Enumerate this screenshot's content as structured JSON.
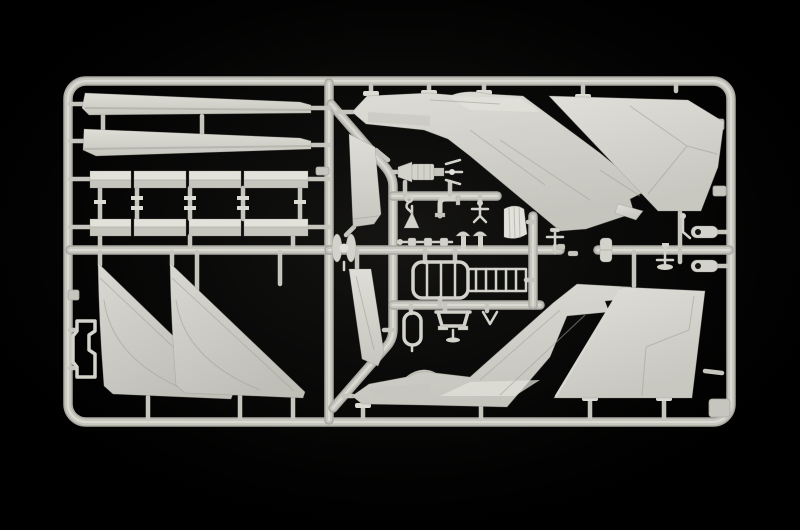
{
  "meta": {
    "title": "Model kit sprue photograph",
    "alt": "Photograph of a light grey injection-moulded plastic model aircraft sprue on a black background, containing delta wing panels, fuselage halves, tail fins, wing slats, elevon strips and many small detail parts attached to a rectangular runner frame"
  },
  "colors": {
    "bg": "#000000",
    "vignette": "#2c2b28",
    "plastic": "#d3d2cb",
    "plastic_hi": "#e2e1da",
    "plastic_mid": "#c6c5be",
    "plastic_lo": "#b2b1aa",
    "runner": "#c6c5be",
    "runner_hi": "#dbdad3",
    "runner_lo": "#a9a8a1",
    "panel": "#a3a29b",
    "hole": "#141412"
  },
  "sprue": {
    "material": "light grey styrene plastic",
    "background": "black studio backdrop",
    "frame": {
      "shape": "rounded rectangle runner frame with internal vertical divider, curved spine runner and horizontal cluster runners",
      "corner_gusset": "bottom-right inner corner pad"
    },
    "parts": [
      {
        "name": "wing-slat-upper",
        "desc": "long tapered leading-edge slat strip, top left"
      },
      {
        "name": "wing-slat-lower",
        "desc": "long tapered leading-edge slat strip, second row"
      },
      {
        "name": "elevon-row-upper",
        "desc": "row of four flat elevon/flap segments"
      },
      {
        "name": "elevon-row-lower",
        "desc": "row of four flat elevon/flap segments"
      },
      {
        "name": "elevon-links",
        "desc": "vertical moulding links with flanges joining the two elevon rows"
      },
      {
        "name": "delta-wing-left",
        "desc": "large triangular delta wing panel"
      },
      {
        "name": "delta-wing-right",
        "desc": "large triangular delta wing panel"
      },
      {
        "name": "canopy-frame-bracket",
        "desc": "small open rectangular frame part on left edge"
      },
      {
        "name": "rudder-panel-upper",
        "desc": "narrow trapezoid panel beside curved spine runner"
      },
      {
        "name": "rudder-panel-lower",
        "desc": "narrow slanted panel below centre"
      },
      {
        "name": "fuselage-half-upper",
        "desc": "fuselage half, nose left, tail swept down-right with stepped exhaust"
      },
      {
        "name": "fuselage-half-lower",
        "desc": "mirrored fuselage half, nose left, tail swept up-right with stepped exhaust"
      },
      {
        "name": "tail-fin-upper",
        "desc": "large swept vertical stabilizer, top right"
      },
      {
        "name": "tail-fin-lower",
        "desc": "large swept vertical stabilizer, bottom right"
      },
      {
        "name": "ejection-seat",
        "desc": "finned cylindrical detail part moulded horizontally"
      },
      {
        "name": "hook-part",
        "desc": "small hook with ring"
      },
      {
        "name": "stand-part",
        "desc": "small triangular stand"
      },
      {
        "name": "intake-pipe",
        "desc": "L-shaped pipe with flanges"
      },
      {
        "name": "linkage-part",
        "desc": "small T-shaped linkage"
      },
      {
        "name": "actuator-rod",
        "desc": "rod with three coupling blocks"
      },
      {
        "name": "mushroom-valve-1",
        "desc": "small mushroom-headed part"
      },
      {
        "name": "mushroom-valve-2",
        "desc": "small mushroom-headed part"
      },
      {
        "name": "canopy-shell",
        "desc": "curved windscreen shell with frame ribs"
      },
      {
        "name": "t-valve",
        "desc": "T-handle valve part"
      },
      {
        "name": "small-cylinder",
        "desc": "small ribbed drum"
      },
      {
        "name": "cockpit-tub-frame",
        "desc": "rounded rectangular frame with three rungs"
      },
      {
        "name": "boarding-ladder",
        "desc": "ladder strip with six rungs"
      },
      {
        "name": "oxygen-bottle",
        "desc": "elongated bottle outline part"
      },
      {
        "name": "landing-gear-yoke",
        "desc": "yoke bracket with two feet and centre stem"
      },
      {
        "name": "v-brace",
        "desc": "small V-shaped brace"
      },
      {
        "name": "capstan-wheel",
        "desc": "two-lobed capstan part on the vertical divider"
      },
      {
        "name": "anchor-lever",
        "desc": "T-lever with oval base, right column"
      },
      {
        "name": "bent-lever",
        "desc": "small bent lever, right column"
      },
      {
        "name": "gear-door-pill-1",
        "desc": "rounded pill-shaped door with hole"
      },
      {
        "name": "gear-door-pill-2",
        "desc": "rounded pill-shaped door with hole"
      }
    ]
  }
}
